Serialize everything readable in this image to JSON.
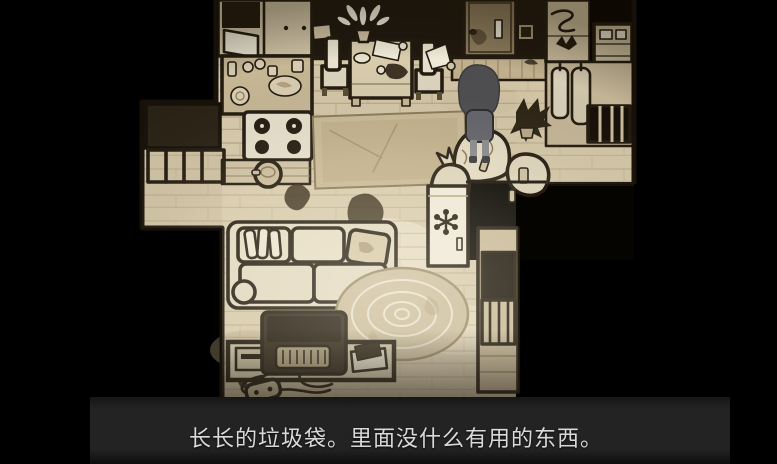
{
  "subtitle": {
    "text": "长长的垃圾袋。里面没什么有用的东西。"
  },
  "palette": {
    "background": "#000000",
    "floor": "#d8cbae",
    "floor_bright": "#efe8d4",
    "outline_ink": "#241c10",
    "wall_dark": "#221a10",
    "door": "#8d7c5d",
    "character_hair": "#4e4e50",
    "subtitle_bar": "#232323",
    "subtitle_text": "#d9d9d9"
  },
  "scene": {
    "view": "top-down apartment",
    "objects": [
      "kitchen-cabinets",
      "kitchen-counter",
      "stove",
      "cooking-pot",
      "sideboard",
      "left-window",
      "left-railing",
      "entry-door",
      "door-handle",
      "mail-slot",
      "light-switch",
      "doormat",
      "dining-table",
      "potted-plant",
      "dining-chair-left",
      "dining-chair-right",
      "hall-shelf",
      "upper-shelf",
      "wardrobe-coats",
      "wardrobe-window",
      "player-character",
      "paper-note",
      "area-rug",
      "garbage-bags",
      "dead-plant",
      "mini-fridge",
      "snowflake-icon",
      "balcony-window",
      "couch",
      "round-rug",
      "tv",
      "vcr",
      "books",
      "game-console",
      "cables",
      "floor-stains"
    ]
  }
}
